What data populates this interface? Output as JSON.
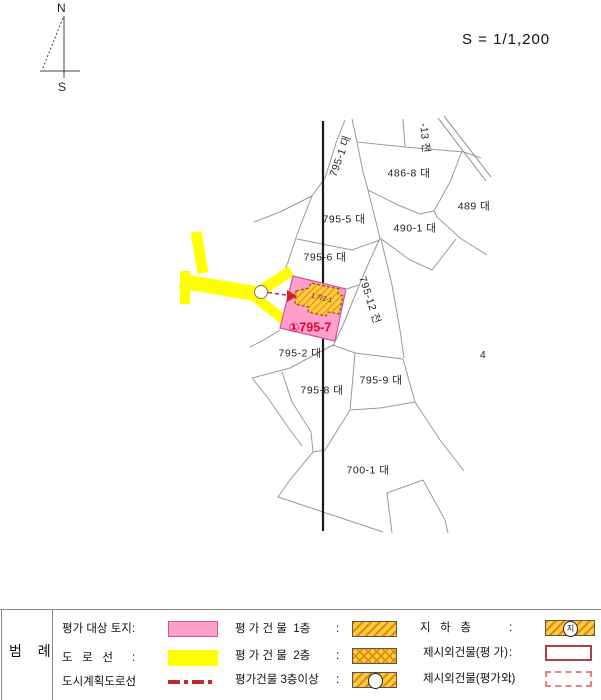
{
  "compass": {
    "north": "N",
    "south": "S"
  },
  "scale_label": "S = 1/1,200",
  "map": {
    "subject_label": "①795-7",
    "building_label": "1.㉮2-1",
    "parcels": [
      {
        "text": "795-1 대",
        "x": 340,
        "y": 156,
        "rot": -70
      },
      {
        "text": "-13 전",
        "x": 425,
        "y": 138,
        "rot": 85
      },
      {
        "text": "486-8 대",
        "x": 409,
        "y": 173,
        "rot": 0
      },
      {
        "text": "489 대",
        "x": 474,
        "y": 206,
        "rot": 0
      },
      {
        "text": "490-1 대",
        "x": 415,
        "y": 228,
        "rot": 0
      },
      {
        "text": "795-5 대",
        "x": 344,
        "y": 219,
        "rot": 0
      },
      {
        "text": "795-6 대",
        "x": 325,
        "y": 257,
        "rot": 0
      },
      {
        "text": "795-12 전",
        "x": 370,
        "y": 300,
        "rot": 72
      },
      {
        "text": "795-2 대",
        "x": 300,
        "y": 353,
        "rot": 0
      },
      {
        "text": "795-8 대",
        "x": 322,
        "y": 390,
        "rot": 0
      },
      {
        "text": "795-9 대",
        "x": 381,
        "y": 380,
        "rot": 0
      },
      {
        "text": "700-1 대",
        "x": 368,
        "y": 470,
        "rot": 0
      },
      {
        "text": "4",
        "x": 483,
        "y": 355,
        "rot": 0
      }
    ]
  },
  "legend": {
    "title": "범 례",
    "colon": ":",
    "left": [
      {
        "label": "평가 대상 토지"
      },
      {
        "label": "도   로   선"
      },
      {
        "label": "도시계획도로선"
      }
    ],
    "middle": [
      {
        "label": "평 가 건 물  1층"
      },
      {
        "label": "평 가 건 물  2층"
      },
      {
        "label": "평가건물 3층이상"
      }
    ],
    "right": [
      {
        "label": "지   하   층",
        "swatch_char": "지"
      },
      {
        "label": "제시외건물(평 가)"
      },
      {
        "label": "제시외건물(평가외)"
      }
    ]
  },
  "colors": {
    "subject_land_pink": "#ffa0cc",
    "road_yellow": "#ffff00",
    "building_orange": "#ffc845",
    "building_hatch": "#dc9000",
    "annotation_red": "#e60033",
    "plan_road_red": "#c22a2a"
  }
}
